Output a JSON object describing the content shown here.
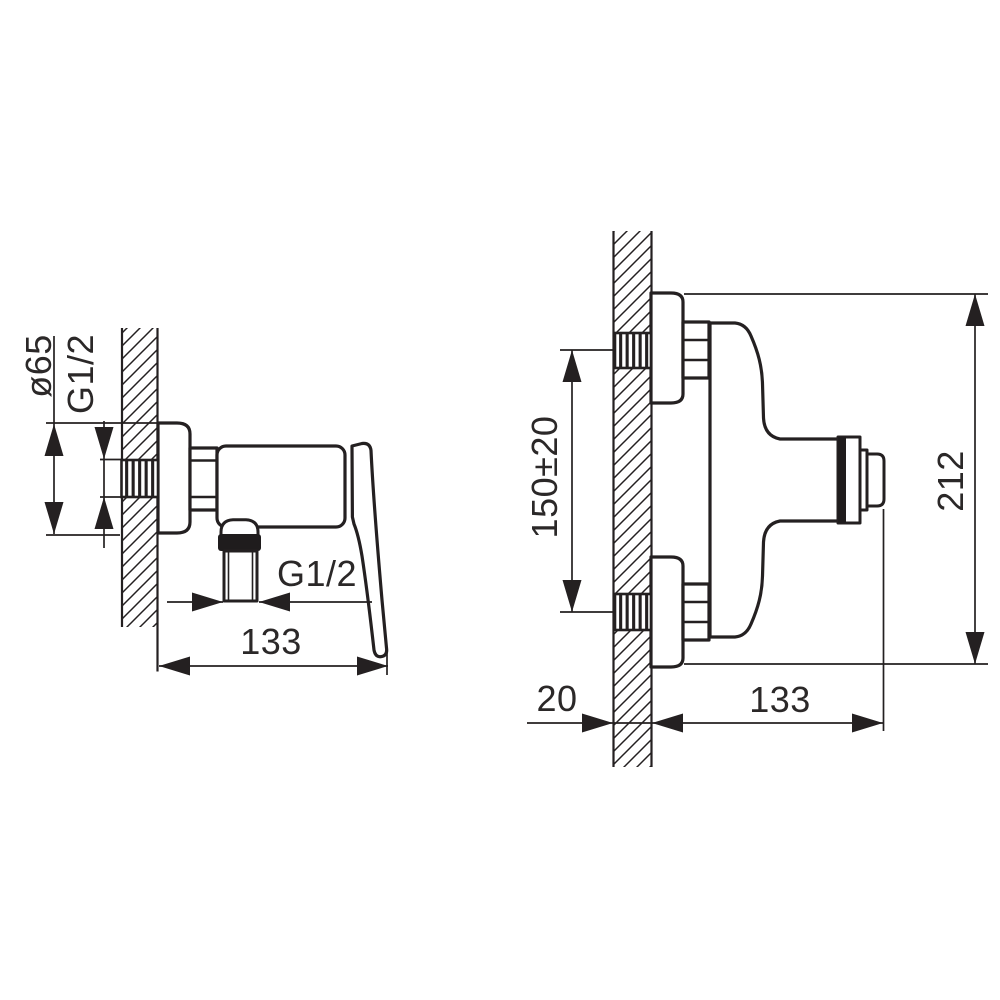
{
  "drawing": {
    "type": "technical-dimension-drawing",
    "subject": "wall-mounted shower mixer tap, two orthographic views",
    "colors": {
      "line": "#242021",
      "background": "#ffffff"
    },
    "views": {
      "side": {
        "title": "side view (wall section left)",
        "dims": {
          "diameter": "ø65",
          "inlet_thread": "G1/2",
          "outlet_thread": "G1/2",
          "depth": "133"
        }
      },
      "front": {
        "title": "plan view (wall section left)",
        "dims": {
          "connection_spacing": "150±20",
          "overall_height": "212",
          "wall_thickness": "20",
          "depth": "133"
        }
      }
    }
  }
}
